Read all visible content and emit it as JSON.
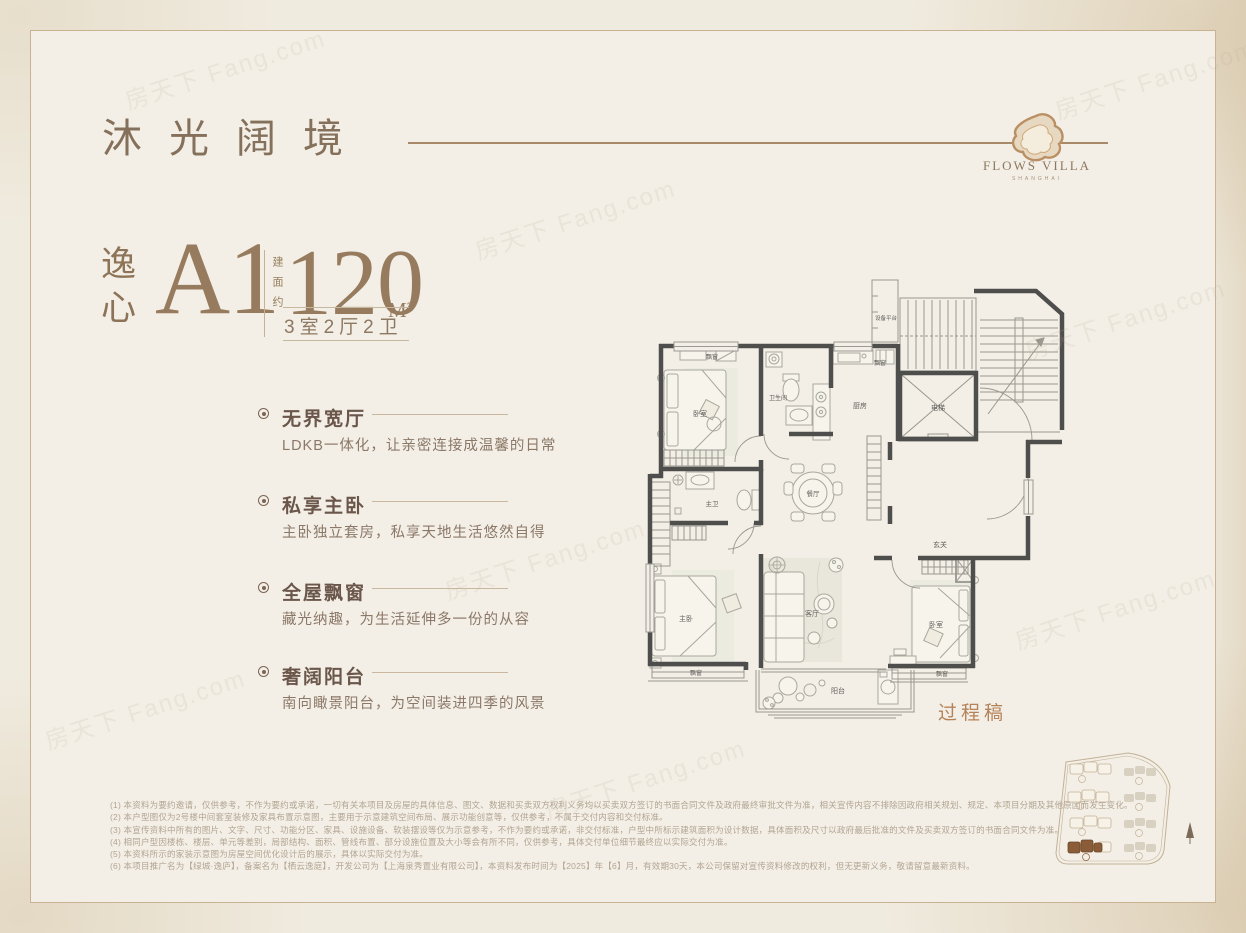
{
  "brand": {
    "title": "沐光阔境",
    "logo_name": "FLOWS VILLA",
    "logo_sub": "SHANGHAI"
  },
  "unit": {
    "series": "逸心",
    "code": "A1",
    "area_prefix": "建面约",
    "area_value": "120",
    "area_unit": "M²",
    "rooms_summary": "3室2厅2卫"
  },
  "features": [
    {
      "title": "无界宽厅",
      "desc": "LDKB一体化，让亲密连接成温馨的日常"
    },
    {
      "title": "私享主卧",
      "desc": "主卧独立套房，私享天地生活悠然自得"
    },
    {
      "title": "全屋飘窗",
      "desc": "藏光纳趣，为生活延伸多一份的从容"
    },
    {
      "title": "奢阔阳台",
      "desc": "南向瞰景阳台，为空间装进四季的风景"
    }
  ],
  "floorplan": {
    "note": "过程稿",
    "labels": [
      "卧室",
      "飘窗",
      "卫生间",
      "厨房",
      "飘窗",
      "设备平台",
      "电梯",
      "餐厅",
      "主卫",
      "玄关",
      "主卧",
      "客厅",
      "卧室",
      "飘窗",
      "飘窗",
      "阳台"
    ]
  },
  "disclaimers": [
    "(1) 本资料为要约邀请，仅供参考，不作为要约或承诺，一切有关本项目及房屋的具体信息、图文、数据和买卖双方权利义务均以买卖双方签订的书面合同文件及政府最终审批文件为准，相关宣传内容不排除因政府相关规划、规定、本项目分期及其他原因而发生变化。",
    "(2) 本户型图仅为2号楼中间套室装修及家具布置示意图，主要用于示意建筑空间布局、展示功能创意等，仅供参考，不属于交付内容和交付标准。",
    "(3) 本宣传资料中所有的图片、文字、尺寸、功能分区、家具、设施设备、软装摆设等仅为示意参考，不作为要约或承诺，非交付标准，户型中所标示建筑面积为设计数据，具体面积及尺寸以政府最后批准的文件及买卖双方签订的书面合同文件为准。",
    "(4) 相同户型因楼栋、楼层、单元等差别，局部结构、面积、管线布置、部分设施位置及大小等会有所不同，仅供参考，具体交付单位细节最终应以实际交付为准。",
    "(5) 本资料所示的家装示意图为房屋空间优化设计后的展示，具体以实际交付为准。",
    "(6) 本项目推广名为【绿城·逸庐】，备案名为【栖云逸庭】，开发公司为【上海泉秀置业有限公司】，本资料发布时间为【2025】年【6】月，有效期30天，本公司保留对宣传资料修改的权利，但无更新义务，敬请留意最新资料。"
  ],
  "watermark": "房天下 Fang.com",
  "colors": {
    "accent": "#a98a68",
    "wall": "#4e4e4c",
    "highlight_building": "#8a5c38",
    "note": "#b5835a"
  }
}
